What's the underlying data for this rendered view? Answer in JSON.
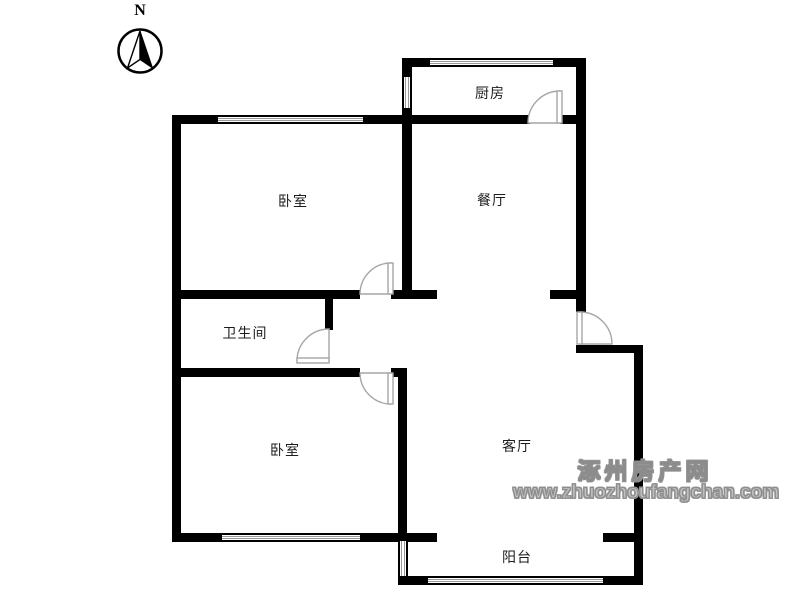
{
  "meta": {
    "background_color": "#ffffff",
    "wall_color": "#000000",
    "window_line_color": "#9a9a9a",
    "door_line_color": "#a6a6a6",
    "label_color": "#1c1c1c",
    "watermark_fill_color": "#c0c0c0",
    "watermark_outline_color": "#8c8c8c"
  },
  "compass": {
    "label": "N"
  },
  "rooms": [
    {
      "id": "kitchen",
      "label": "厨房"
    },
    {
      "id": "dining-room",
      "label": "餐厅"
    },
    {
      "id": "bedroom-top",
      "label": "卧室"
    },
    {
      "id": "bathroom",
      "label": "卫生间"
    },
    {
      "id": "bedroom-bottom",
      "label": "卧室"
    },
    {
      "id": "living-room",
      "label": "客厅"
    },
    {
      "id": "balcony",
      "label": "阳台"
    }
  ],
  "watermark": {
    "site_name": "涿州房产网",
    "url": "www.zhuozhoufangchan.com"
  }
}
